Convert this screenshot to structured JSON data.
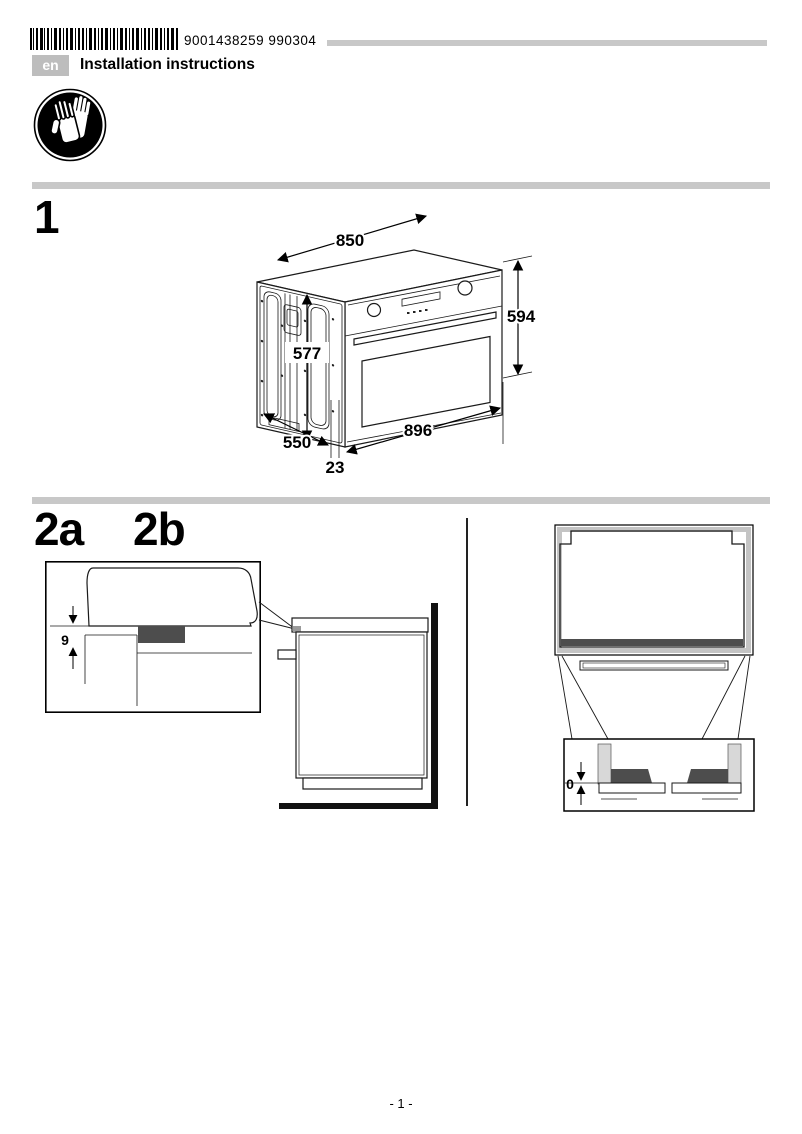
{
  "header": {
    "barcode_number": "9001438259  990304",
    "language_code": "en",
    "title": "Installation instructions"
  },
  "safety": {
    "icon": "wear-protective-gloves-icon"
  },
  "sections": {
    "step1": {
      "label": "1",
      "dims": {
        "width_top": "850",
        "height_right": "594",
        "height_side": "577",
        "depth": "550",
        "width_front": "896",
        "gap_bottom": "23"
      }
    },
    "step2a": {
      "label": "2a",
      "dims": {
        "gap": "9"
      }
    },
    "step2b": {
      "label": "2b",
      "dims": {
        "gap": "0"
      }
    }
  },
  "footer": {
    "page_number": "- 1 -"
  }
}
